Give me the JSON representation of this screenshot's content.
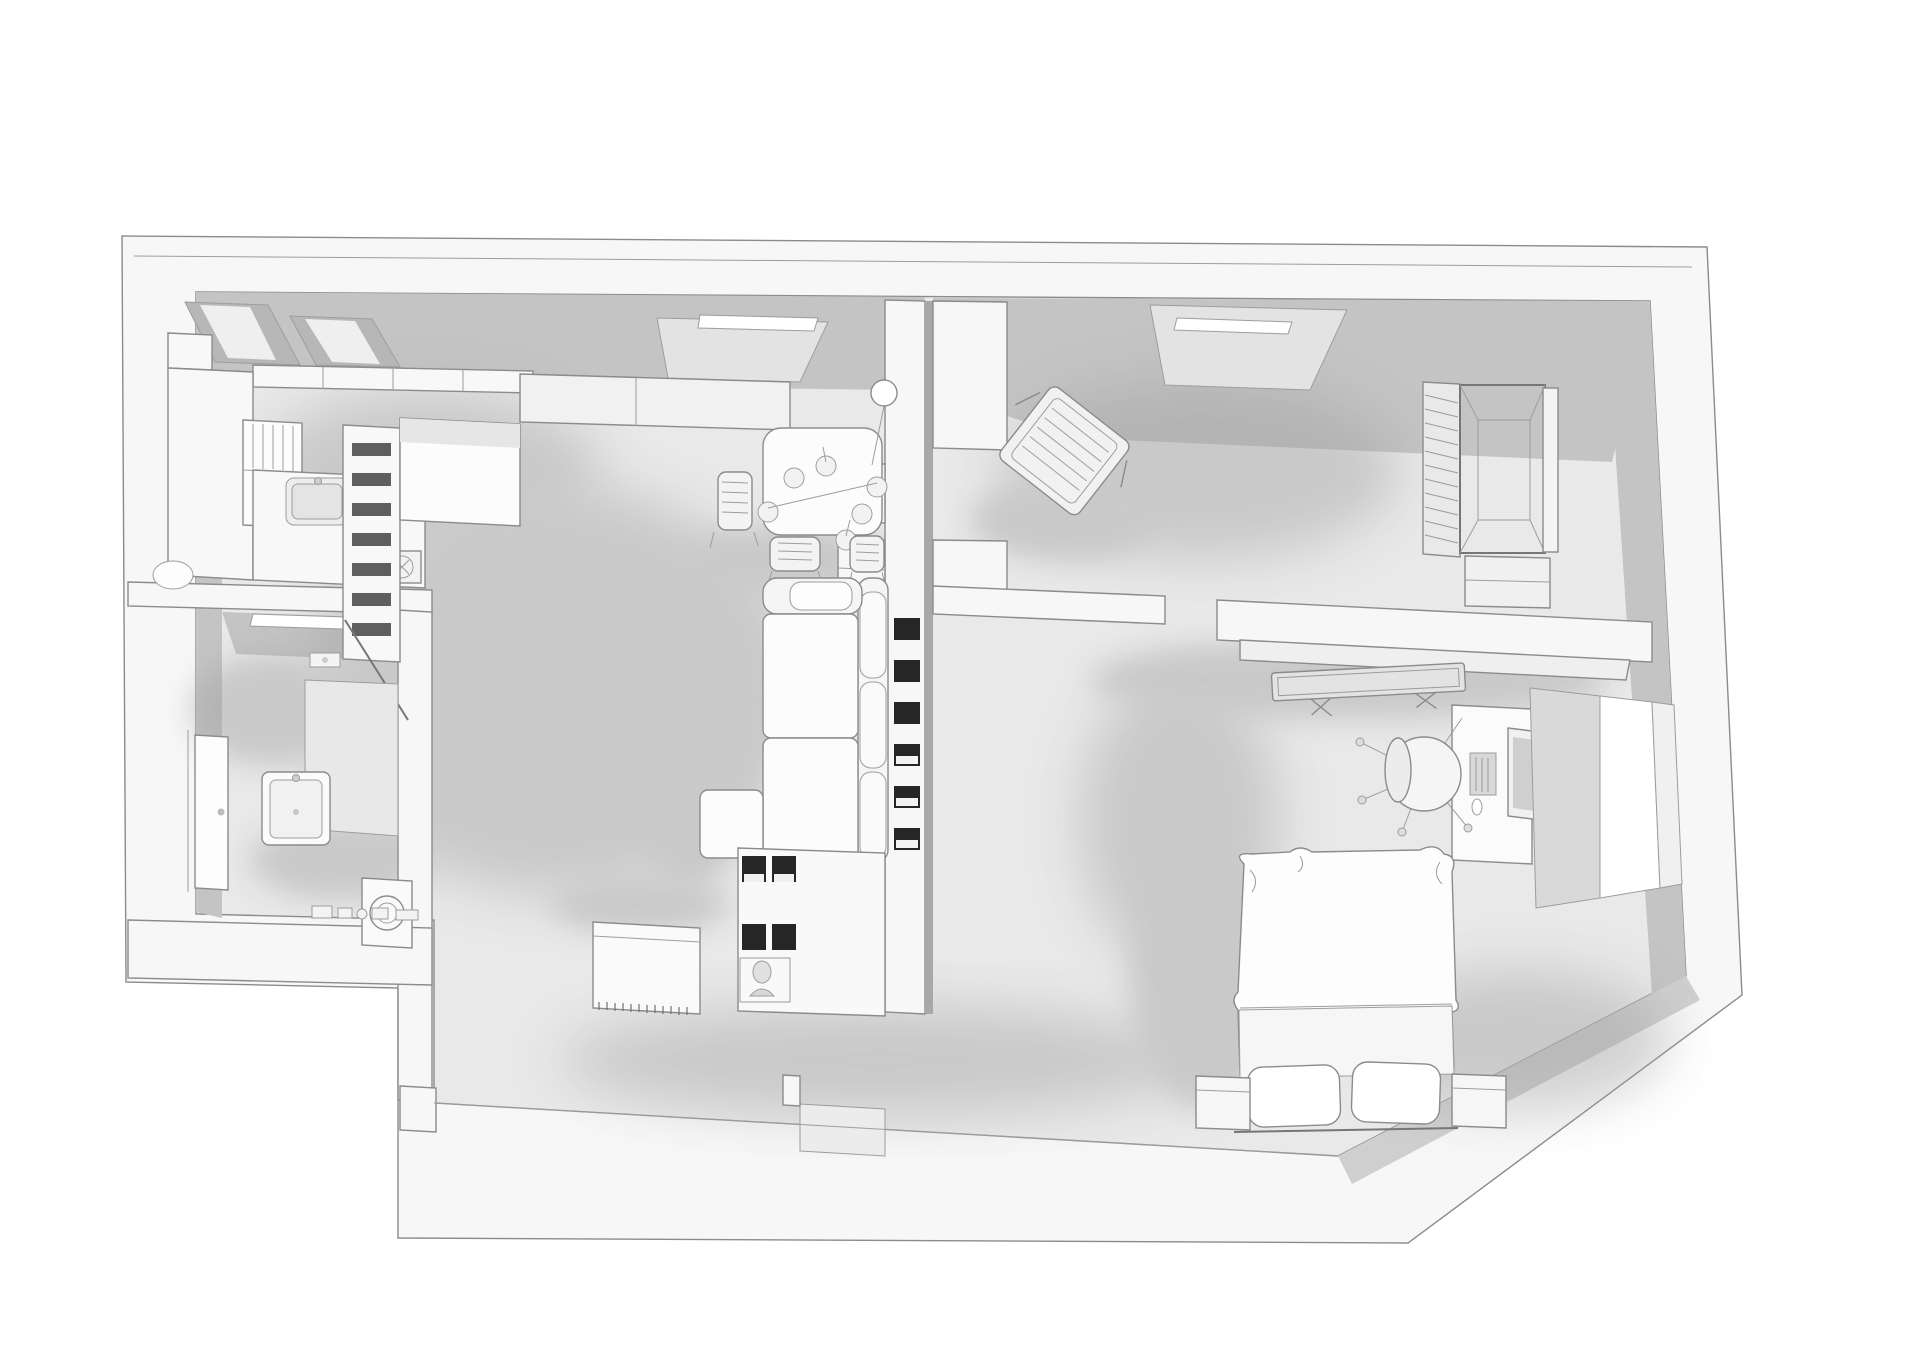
{
  "scene": {
    "title": "monochrome-3d-apartment-floorplan",
    "render_style": "clay-white-ambient-occlusion",
    "projection": "birds-eye-perspective",
    "text_visible": "none"
  },
  "colors": {
    "background": "#ffffff",
    "wall": "#f7f7f7",
    "wall_face_shaded": "#c4c4c4",
    "wall_face_dark": "#b0b0b0",
    "floor": "#e9e9e9",
    "floor_bath": "#e4e4e4",
    "furniture": "#f8f8f8",
    "furniture_bright": "#fdfdfd",
    "niche_dark": "#262626",
    "slot_dark": "#5f5f5f",
    "window_light": "#ffffff",
    "lightwell": "#e3e3e3",
    "shadow": "#9e9e9e",
    "line": "#8b8b8b"
  },
  "rooms": [
    {
      "id": "kitchen",
      "furniture": [
        "pantry-corner-shelves",
        "wall-cabinets",
        "tall-cabinet",
        "left-counter",
        "dish-rack",
        "sink",
        "hob",
        "ladder-shelf",
        "kitchen-island",
        "kettle"
      ]
    },
    {
      "id": "bathroom",
      "furniture": [
        "ceiling-light-slit",
        "shower-screen",
        "shower-tray",
        "shower-head",
        "door",
        "washbasin",
        "washing-machine",
        "toiletry-shelf"
      ]
    },
    {
      "id": "living-dining",
      "furniture": [
        "skylight",
        "wall-shelf",
        "dining-table",
        "pendant-lamp",
        "dining-chair",
        "dining-chair",
        "dining-chair",
        "sofa",
        "chaise",
        "sideboard",
        "media-cubby-unit",
        "bust-figurine"
      ]
    },
    {
      "id": "hallway-divider",
      "furniture": [
        "cubby-niches",
        "pass-through-shelves"
      ]
    },
    {
      "id": "study",
      "furniture": [
        "skylight-window",
        "lounge-chair",
        "wardrobe-louvered"
      ]
    },
    {
      "id": "bedroom",
      "furniture": [
        "tv-on-shelf",
        "desk",
        "monitor",
        "keyboard",
        "mouse",
        "office-chair",
        "bed",
        "pillow",
        "pillow",
        "nightstand",
        "nightstand",
        "window-bay"
      ]
    }
  ],
  "counts": {
    "cubby_wall_niches": 6,
    "media_unit_niches": 4,
    "dining_chairs": 3,
    "pendant_bulbs": 6,
    "pillows": 2,
    "nightstands": 2,
    "skylights": 2
  }
}
